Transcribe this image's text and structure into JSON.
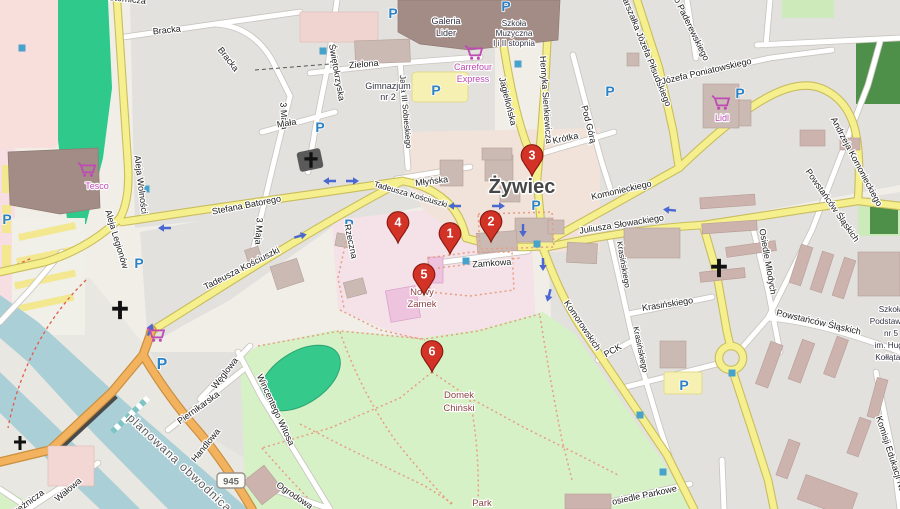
{
  "town": {
    "name": "Żywiec"
  },
  "streets": {
    "bracka": "Bracka",
    "sternicza": "Sternicza",
    "aleja_wolnosci": "Aleja Wolności",
    "aleja_legionow": "Aleja Legionów",
    "maja3": "3 Maja",
    "mala": "Mała",
    "swietokrzyska": "Świętokrzyska",
    "stefana_batorego": "Stefana Batorego",
    "tadeusza_kosciuszki": "Tadeusza Kościuszki",
    "rzeczna": "Rzeczna",
    "mlynska": "Młyńska",
    "zamkowa": "Zamkowa",
    "zielona": "Zielona",
    "jagiellonska": "Jagiellońska",
    "sienkiewicza": "Henryka Sienkiewicza",
    "pod_gora": "Pod Górą",
    "krotka": "Krótka",
    "komonieckiego": "Komonieckiego",
    "slowackiego": "Juliusza Słowackiego",
    "komorowskich": "Komorowskich",
    "krasinskiego": "Krasińskiego",
    "pck": "PCK",
    "osiedle_mlodych": "Osiedle Młodych",
    "powstancow": "Powstańców Śląskich",
    "pilsudskiego": "Marszałka Józefa Piłsudskiego",
    "paderewskiego": "Ignacego Paderewskiego",
    "poniatowskiego": "Józefa Poniatowskiego",
    "andrzeja_komonieckiego": "Andrzeja Komonieckiego",
    "weglowa": "Węglowa",
    "piernikarska": "Piernikarska",
    "handlowa": "Handlowa",
    "planowana_obwodnica": "planowana obwodnica",
    "walowa": "Wałowa",
    "rzeznicza": "Rzeźnicza",
    "witosa": "Wincentego Witosa",
    "ogrodowa": "Ogrodowa",
    "osiedle_parkowe": "osiedle Parkowe",
    "komisji": "Komisji Edukacji Narodowej",
    "sobieskiego": "Jana III Sobieskiego"
  },
  "pois": {
    "galeria1": "Galeria",
    "galeria2": "Lider",
    "muz1": "Szkoła",
    "muz2": "Muzyczna",
    "muz3": "I i II stopnia",
    "carrefour1": "Carrefour",
    "carrefour2": "Express",
    "gim1": "Gimnazjum",
    "gim2": "nr 2",
    "tesco": "Tesco",
    "lidl": "Lidl",
    "zamek1": "Nowy",
    "zamek2": "Zamek",
    "domek1": "Domek",
    "domek2": "Chiński",
    "park": "Park",
    "sp1": "Szkoła",
    "sp2": "Podstawowa",
    "sp3": "nr 5",
    "sp4": "im. Hugo",
    "sp5": "Kołłątaja"
  },
  "markers": {
    "m1": "1",
    "m2": "2",
    "m3": "3",
    "m4": "4",
    "m5": "5",
    "m6": "6"
  },
  "road_shield": "945",
  "icons": {
    "parking_letter": "P"
  },
  "colors": {
    "marker": "#d33227",
    "road_secondary": "#f5ef8e",
    "road_primary": "#f2b25e",
    "water": "#abcfd6",
    "park": "#d7f1c7",
    "pitch": "#35c98c",
    "shop_label": "#bf49b5",
    "attraction_label": "#8d4346",
    "parking_blue": "#2e82c3"
  }
}
